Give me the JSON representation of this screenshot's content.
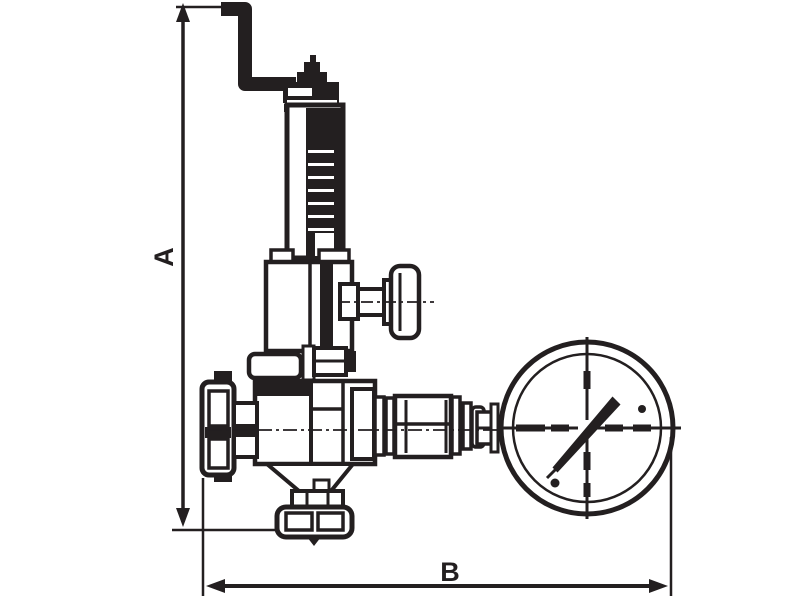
{
  "page": {
    "background_color": "#ffffff",
    "description": "Technical line drawing of a pressure reducing valve with pressure gauge, side elevation, with overall dimension lines"
  },
  "diagram": {
    "type": "technical-drawing",
    "ink_color": "#231f20",
    "dimension_labels": {
      "height": "A",
      "width": "B"
    },
    "parts": [
      "adjusting-crank-rod",
      "adjusting-screw-pin",
      "cap-nut",
      "spring-housing",
      "spring",
      "bonnet",
      "gauge-isolation-tap",
      "t-handle",
      "top-flange",
      "valve-body",
      "inlet-flange",
      "pipe-connector",
      "union-coupling",
      "gauge-stem",
      "pressure-gauge",
      "gauge-needle",
      "outlet-funnel",
      "bottom-outlet-flange",
      "dimension-line-a",
      "dimension-line-b"
    ]
  }
}
